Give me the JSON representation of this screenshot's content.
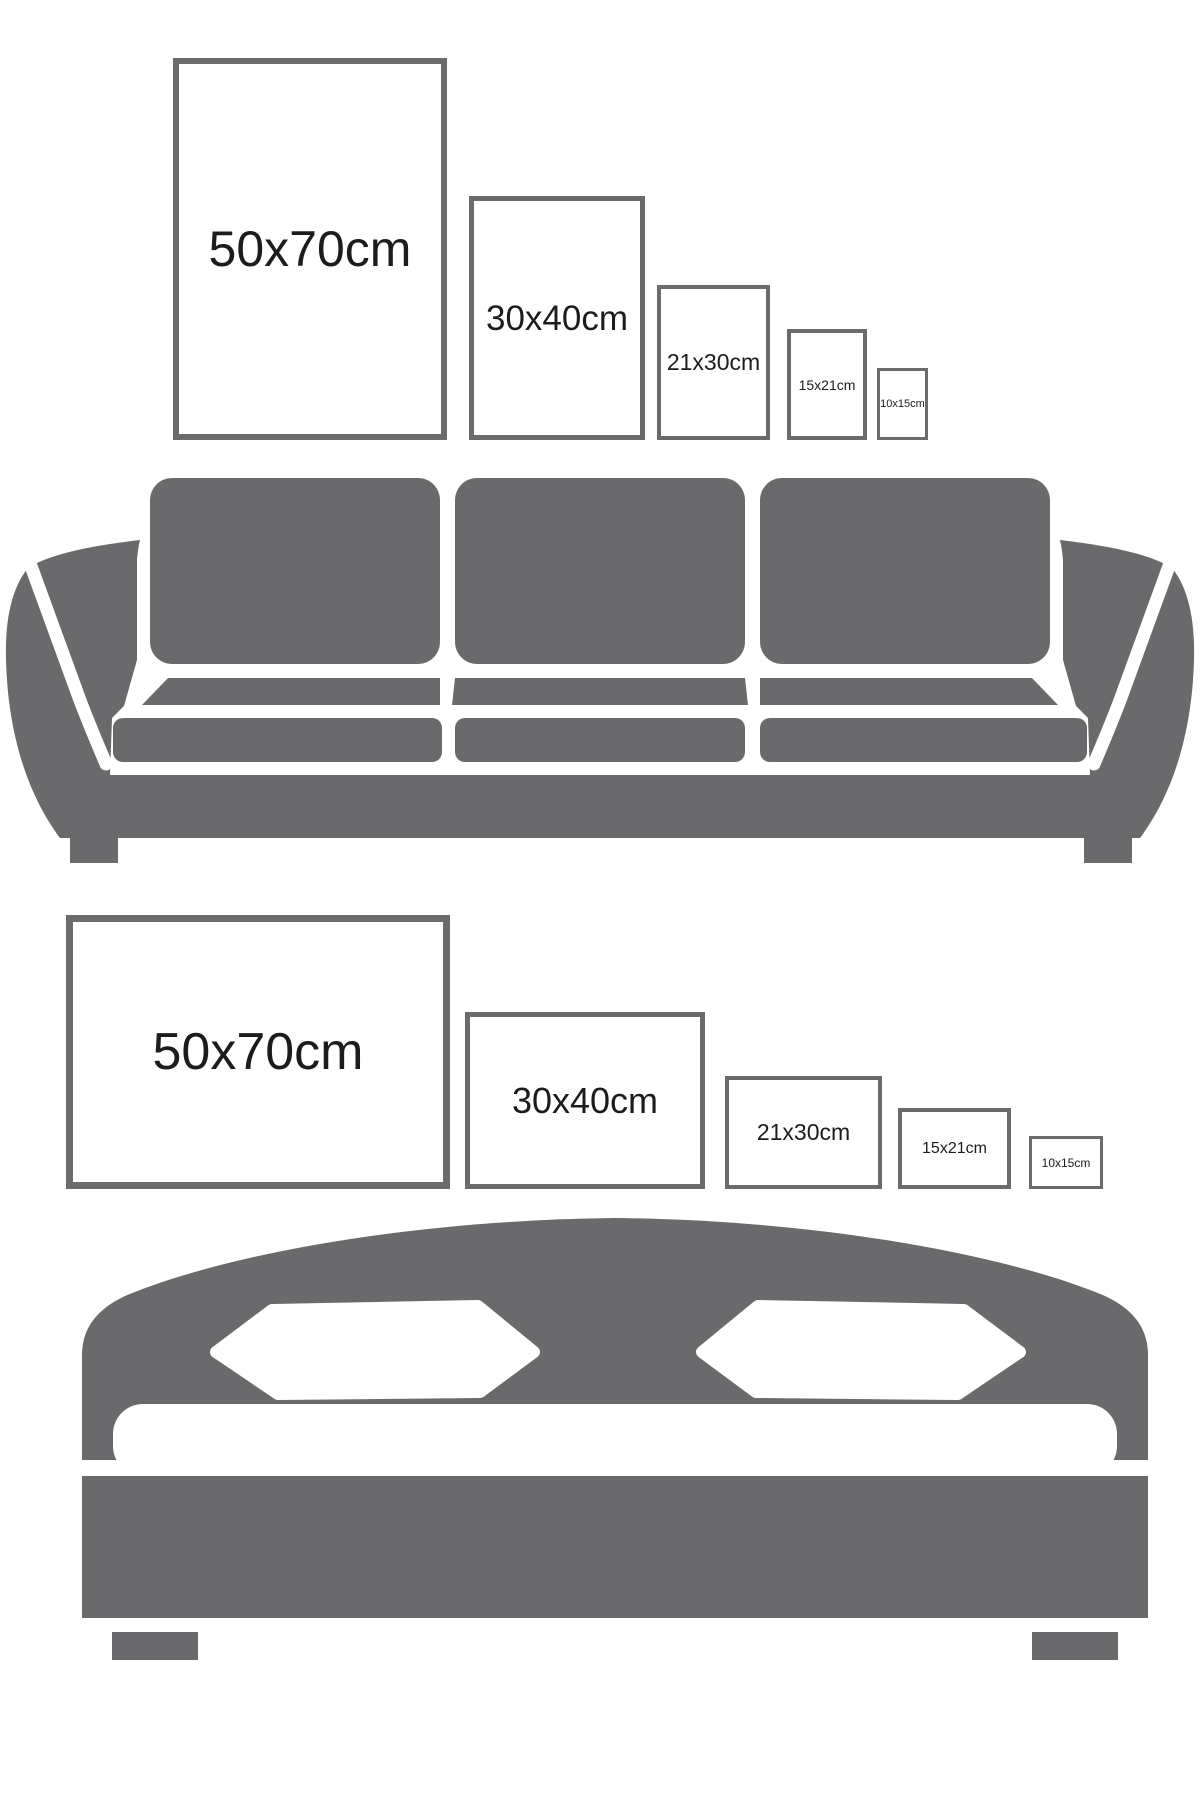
{
  "colors": {
    "background": "#ffffff",
    "furniture_gray": "#6a6a6c",
    "frame_border_gray": "#6b6b6d",
    "label_text": "#1c1c1c"
  },
  "sofa_section": {
    "illustration": "sofa-icon",
    "frames": [
      {
        "label": "50x70cm",
        "width_cm": 50,
        "height_cm": 70,
        "orientation": "portrait"
      },
      {
        "label": "30x40cm",
        "width_cm": 30,
        "height_cm": 40,
        "orientation": "portrait"
      },
      {
        "label": "21x30cm",
        "width_cm": 21,
        "height_cm": 30,
        "orientation": "portrait"
      },
      {
        "label": "15x21cm",
        "width_cm": 15,
        "height_cm": 21,
        "orientation": "portrait"
      },
      {
        "label": "10x15cm",
        "width_cm": 10,
        "height_cm": 15,
        "orientation": "portrait"
      }
    ]
  },
  "bed_section": {
    "illustration": "bed-icon",
    "frames": [
      {
        "label": "50x70cm",
        "width_cm": 70,
        "height_cm": 50,
        "orientation": "landscape"
      },
      {
        "label": "30x40cm",
        "width_cm": 40,
        "height_cm": 30,
        "orientation": "landscape"
      },
      {
        "label": "21x30cm",
        "width_cm": 30,
        "height_cm": 21,
        "orientation": "landscape"
      },
      {
        "label": "15x21cm",
        "width_cm": 21,
        "height_cm": 15,
        "orientation": "landscape"
      },
      {
        "label": "10x15cm",
        "width_cm": 15,
        "height_cm": 10,
        "orientation": "landscape"
      }
    ]
  }
}
